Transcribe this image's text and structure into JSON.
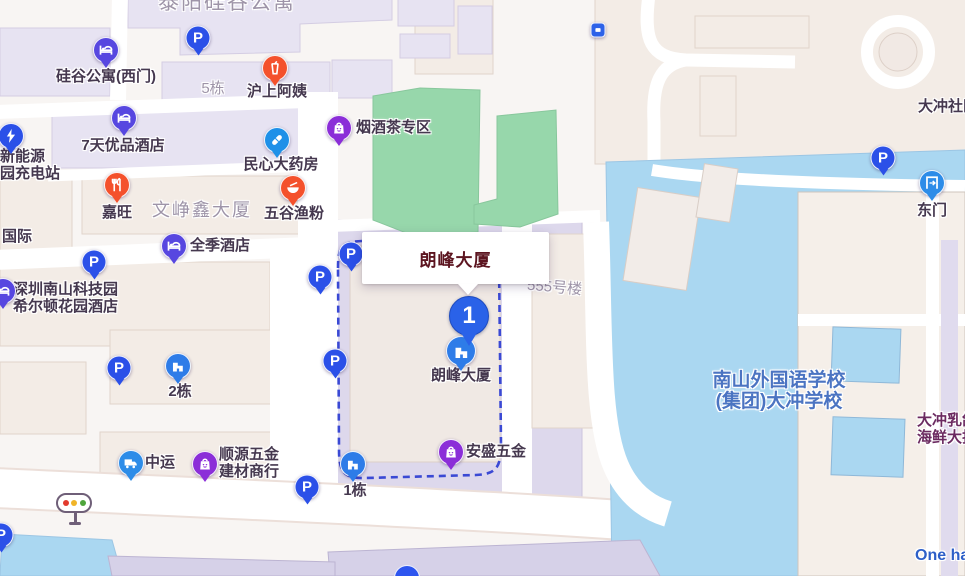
{
  "info_window": {
    "title": "朗峰大厦"
  },
  "destination_pin": {
    "number": "1"
  },
  "colors": {
    "parking": "#2b50e8",
    "hotel": "#5747e0",
    "restaurant": "#f4512c",
    "drink": "#f4512c",
    "bowl": "#f4512c",
    "pharmacy": "#1e90e8",
    "shopping": "#8b2ed8",
    "building": "#2e7ce8",
    "truck": "#2d8ce8",
    "gate": "#2d8ce8",
    "charging": "#2b50e8",
    "transit": "#2d62e8",
    "pin": "#2a62e8",
    "route_dash": "#3a49d4",
    "water": "#aad7f1",
    "park": "#97d7ab",
    "label_dark": "#45384f",
    "label_gray": "#9e94a8",
    "label_blue": "#4b74c2",
    "label_blue2": "#2d5fc8",
    "label_purple": "#6b2a60",
    "info_title": "#5c1520"
  },
  "markers": [
    {
      "id": "parking-taiyang",
      "type": "parking",
      "x": 198,
      "y": 38
    },
    {
      "id": "guigu-apartment-west-gate",
      "type": "hotel",
      "x": 106,
      "y": 50,
      "label": {
        "lines": [
          "硅谷公寓(西门)"
        ],
        "x": 106,
        "y": 69,
        "align": "center",
        "size": 15
      }
    },
    {
      "id": "hushang-ayi",
      "type": "drink",
      "x": 275,
      "y": 68,
      "label": {
        "lines": [
          "沪上阿姨"
        ],
        "x": 277,
        "y": 84,
        "align": "center",
        "size": 15
      }
    },
    {
      "id": "7days-premium-hotel",
      "type": "hotel",
      "x": 124,
      "y": 118,
      "label": {
        "lines": [
          "7天优品酒店"
        ],
        "x": 123,
        "y": 138,
        "align": "center",
        "size": 15
      }
    },
    {
      "id": "charging-station",
      "type": "charging",
      "x": 11,
      "y": 136,
      "label": {
        "lines": [
          "新能源",
          "园充电站"
        ],
        "x": 0,
        "y": 149,
        "align": "left",
        "size": 15
      }
    },
    {
      "id": "minxin-pharmacy",
      "type": "pharmacy",
      "x": 277,
      "y": 140,
      "label": {
        "lines": [
          "民心大药房"
        ],
        "x": 281,
        "y": 157,
        "align": "center",
        "size": 15
      }
    },
    {
      "id": "jiawang",
      "type": "restaurant",
      "x": 117,
      "y": 185,
      "label": {
        "lines": [
          "嘉旺"
        ],
        "x": 117,
        "y": 205,
        "align": "center",
        "size": 15
      }
    },
    {
      "id": "wugu-yufen",
      "type": "bowl",
      "x": 293,
      "y": 188,
      "label": {
        "lines": [
          "五谷渔粉"
        ],
        "x": 294,
        "y": 206,
        "align": "center",
        "size": 15
      }
    },
    {
      "id": "quanji-hotel",
      "type": "hotel",
      "x": 174,
      "y": 246,
      "label": {
        "lines": [
          "全季酒店"
        ],
        "x": 190,
        "y": 238,
        "align": "left",
        "size": 15
      }
    },
    {
      "id": "parking-wenzhengxin",
      "type": "parking",
      "x": 94,
      "y": 262
    },
    {
      "id": "hilton-garden-inn",
      "type": "hotel",
      "x": 3,
      "y": 291,
      "label": {
        "lines": [
          "深圳南山科技园",
          "希尔顿花园酒店"
        ],
        "x": 13,
        "y": 282,
        "align": "left",
        "size": 15
      }
    },
    {
      "id": "parking-west-1",
      "type": "parking",
      "x": 320,
      "y": 277
    },
    {
      "id": "parking-langfeng-nw",
      "type": "parking",
      "x": 351,
      "y": 254
    },
    {
      "id": "yanjiucha-zone",
      "type": "shopping",
      "x": 339,
      "y": 128,
      "label": {
        "lines": [
          "烟酒茶专区"
        ],
        "x": 356,
        "y": 120,
        "align": "left",
        "size": 15
      }
    },
    {
      "id": "parking-west-2",
      "type": "parking",
      "x": 335,
      "y": 361
    },
    {
      "id": "parking-2dong",
      "type": "parking",
      "x": 119,
      "y": 368
    },
    {
      "id": "building-2dong",
      "type": "building",
      "x": 178,
      "y": 366,
      "label": {
        "lines": [
          "2栋"
        ],
        "x": 180,
        "y": 384,
        "align": "center",
        "size": 15
      }
    },
    {
      "id": "zhongyun",
      "type": "truck",
      "x": 131,
      "y": 463,
      "label": {
        "lines": [
          "中运"
        ],
        "x": 145,
        "y": 455,
        "align": "left",
        "size": 15
      }
    },
    {
      "id": "shunyuan-hardware",
      "type": "shopping",
      "x": 205,
      "y": 464,
      "label": {
        "lines": [
          "顺源五金",
          "建材商行"
        ],
        "x": 219,
        "y": 447,
        "align": "left",
        "size": 15
      }
    },
    {
      "id": "parking-south",
      "type": "parking",
      "x": 307,
      "y": 487
    },
    {
      "id": "building-1dong",
      "type": "building",
      "x": 353,
      "y": 464,
      "label": {
        "lines": [
          "1栋"
        ],
        "x": 355,
        "y": 483,
        "align": "center",
        "size": 15
      }
    },
    {
      "id": "ansheng-hardware",
      "type": "shopping",
      "x": 451,
      "y": 452,
      "label": {
        "lines": [
          "安盛五金"
        ],
        "x": 466,
        "y": 444,
        "align": "left",
        "size": 15
      }
    },
    {
      "id": "parking-east",
      "type": "parking",
      "x": 883,
      "y": 158
    },
    {
      "id": "east-gate",
      "type": "gate",
      "x": 932,
      "y": 183,
      "label": {
        "lines": [
          "东门"
        ],
        "x": 932,
        "y": 203,
        "align": "center",
        "size": 15
      }
    },
    {
      "id": "langfeng-building",
      "type": "building",
      "x": 461,
      "y": 351,
      "size": 30,
      "label": {
        "lines": [
          "朗峰大厦"
        ],
        "x": 461,
        "y": 368,
        "align": "center",
        "size": 15
      }
    },
    {
      "id": "transit-stop",
      "type": "transit",
      "x": 598,
      "y": 30
    },
    {
      "id": "parking-bottom-left",
      "type": "parking",
      "x": 1,
      "y": 535
    }
  ],
  "texts": [
    {
      "id": "taiyang-complex",
      "lines": [
        "泰阳硅谷公寓"
      ],
      "x": 158,
      "y": -9,
      "size": 21,
      "ls": 2,
      "color": "label_gray",
      "bold": false,
      "align": "left"
    },
    {
      "id": "5dong",
      "lines": [
        "5栋"
      ],
      "x": 213,
      "y": 81,
      "size": 15,
      "color": "label_gray",
      "bold": false,
      "align": "center"
    },
    {
      "id": "wenzhengxin-building",
      "lines": [
        "文峥鑫大厦"
      ],
      "x": 202,
      "y": 200,
      "size": 18,
      "ls": 2,
      "color": "label_gray",
      "bold": false,
      "align": "center"
    },
    {
      "id": "guoji-partial",
      "lines": [
        "国际"
      ],
      "x": 2,
      "y": 229,
      "size": 15,
      "color": "label_dark",
      "bold": true,
      "align": "left"
    },
    {
      "id": "building-555",
      "lines": [
        "555号楼"
      ],
      "x": 527,
      "y": 280,
      "size": 15,
      "color": "label_gray",
      "bold": false,
      "align": "left",
      "rotate": 5
    },
    {
      "id": "dachong-community",
      "lines": [
        "大冲社区"
      ],
      "x": 918,
      "y": 99,
      "size": 15,
      "color": "label_dark",
      "bold": true,
      "align": "left"
    },
    {
      "id": "nanshan-school",
      "lines": [
        "南山外国语学校",
        "(集团)大冲学校"
      ],
      "x": 779,
      "y": 370,
      "size": 19,
      "color": "label_blue",
      "bold": true,
      "align": "center"
    },
    {
      "id": "dachong-restaurant",
      "lines": [
        "大冲乳鸽",
        "海鲜大排档"
      ],
      "x": 917,
      "y": 413,
      "size": 15,
      "color": "label_purple",
      "bold": true,
      "align": "left"
    },
    {
      "id": "one-ha",
      "lines": [
        "One ha"
      ],
      "x": 915,
      "y": 547,
      "size": 16,
      "color": "label_blue2",
      "bold": true,
      "align": "left"
    }
  ]
}
